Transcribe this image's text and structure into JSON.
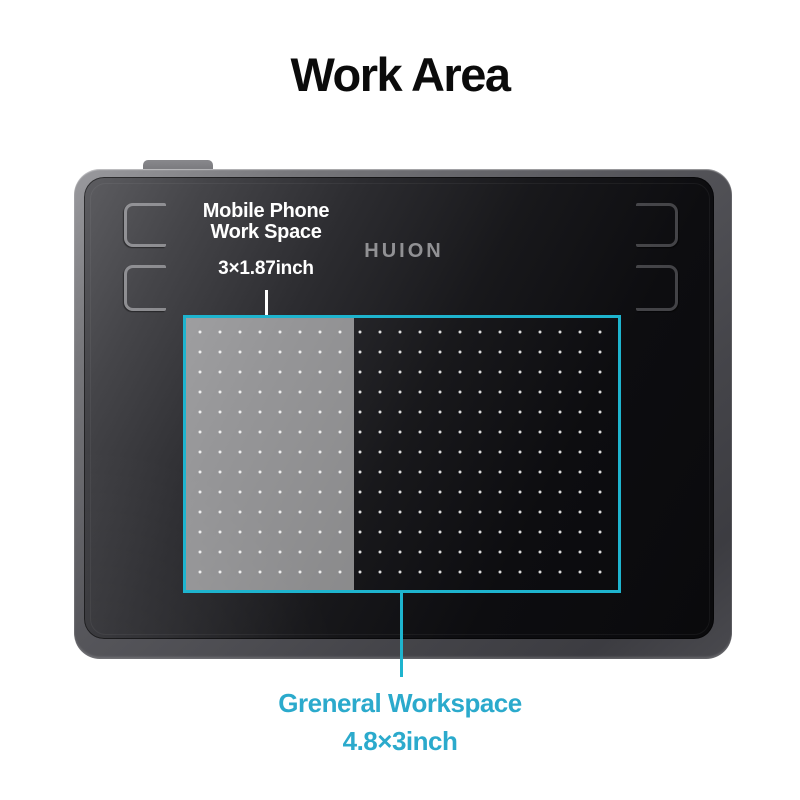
{
  "title": "Work Area",
  "tablet": {
    "logo": "HUION"
  },
  "annotations": {
    "mobile_workspace": {
      "label_line1": "Mobile Phone",
      "label_line2": "Work Space",
      "dimensions": "3×1.87inch"
    },
    "general_workspace": {
      "label": "Greneral Workspace",
      "dimensions": "4.8×3inch"
    }
  },
  "colors": {
    "accent_cyan": "#1EB4CE",
    "text_cyan": "#2BAACC",
    "annotation_white": "#FFFFFF",
    "logo_gray": "#919194",
    "title_black": "#0B0B0B",
    "background": "#FFFFFF"
  }
}
